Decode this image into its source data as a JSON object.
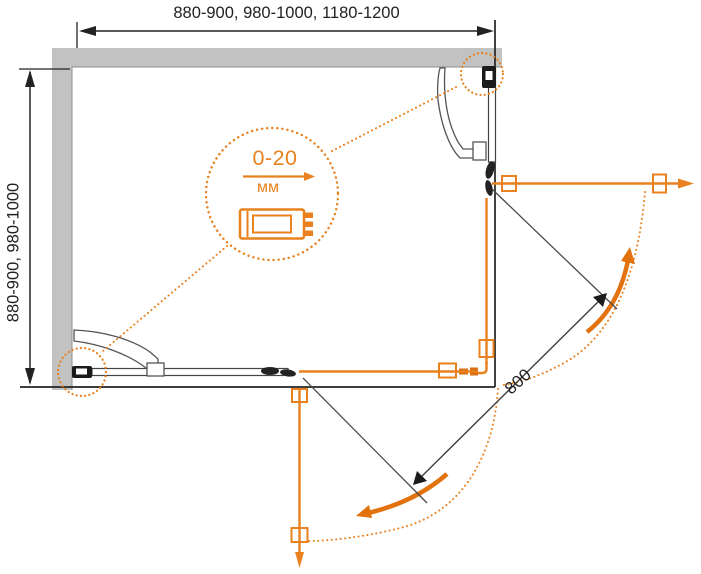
{
  "diagram": {
    "title": "shower-enclosure-plan-diagram",
    "top_width_label": "880-900, 980-1000, 1180-1200",
    "side_depth_label": "880-900, 980-1000",
    "adjustment_value": "0-20",
    "adjustment_unit": "мм",
    "door_width_label": "800"
  },
  "colors": {
    "accent_orange": "#E8811E",
    "arrow_orange": "#E2720D",
    "wall_gray": "#C2C2C2",
    "line_black": "#222222",
    "thin_gray_line": "#4A4A4A"
  }
}
